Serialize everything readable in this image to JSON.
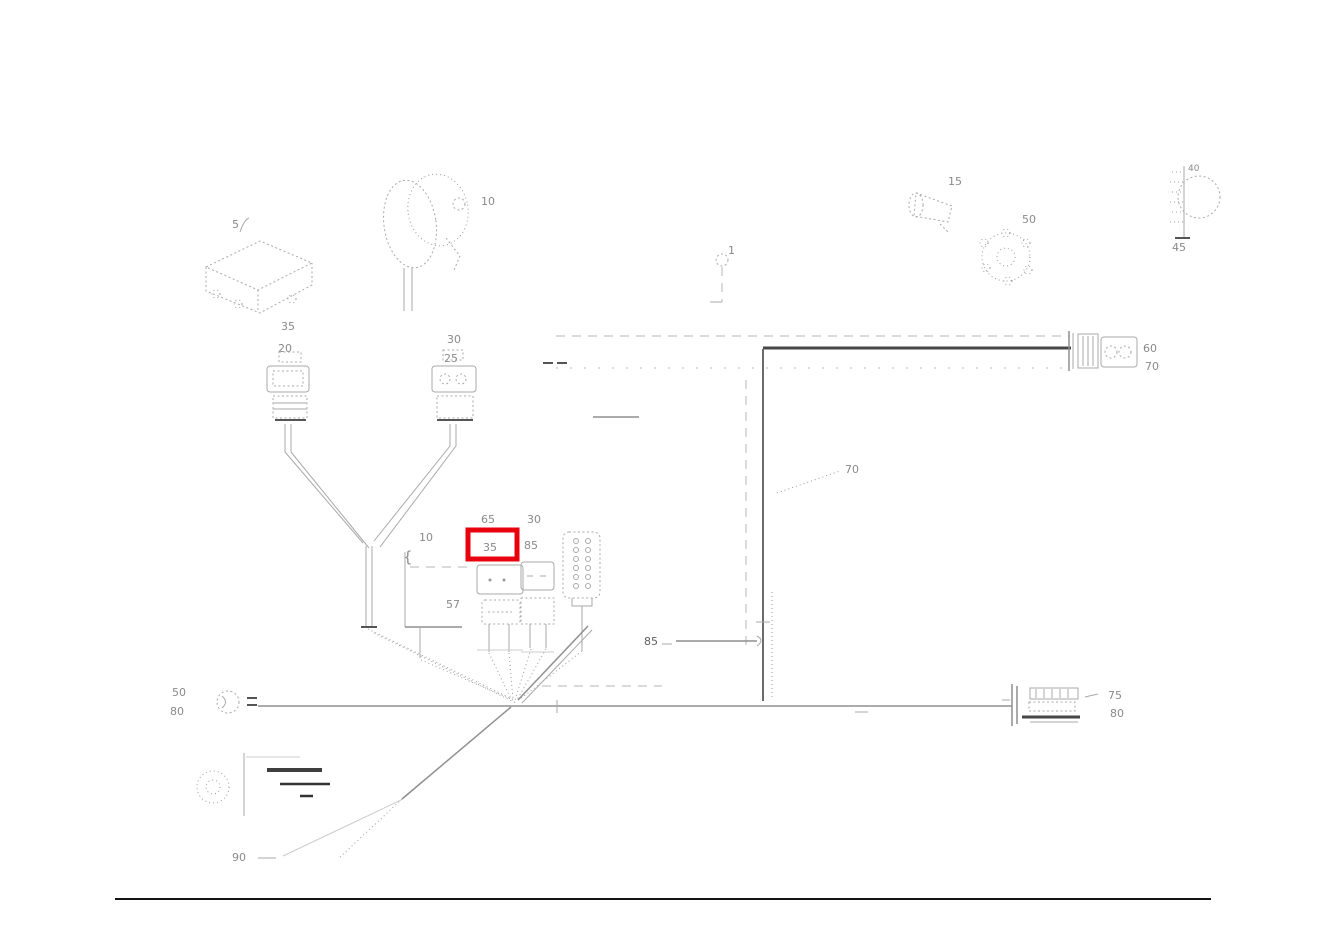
{
  "diagram": {
    "type": "wiring-harness-parts-diagram",
    "colors": {
      "highlight": "#e8000d",
      "sketch": "#a9a9a9",
      "dark_line": "#474747",
      "label": "#8a8a8a",
      "divider": "#141414"
    },
    "callouts": {
      "ecu": "5",
      "horn": "10",
      "cone": "15",
      "conn_a_top": "35",
      "conn_a_bottom": "20",
      "conn_b_top": "30",
      "conn_b_bottom": "25",
      "bracket_num": "10",
      "brace": "{",
      "above_highlight": "65",
      "highlight": "35",
      "relay_top": "30",
      "relay_bottom": "85",
      "bracket_part": "57",
      "stub": "1",
      "trunk_leader": "70",
      "mid_leader": "85",
      "conn_right_top": "60",
      "conn_right_bottom": "70",
      "switch": "50",
      "bulb_top": "40",
      "bulb_bottom": "45",
      "conn_br_top": "75",
      "conn_br_bottom": "80",
      "grommet_top": "50",
      "grommet_bottom": "80",
      "legend_leader": "90"
    }
  }
}
